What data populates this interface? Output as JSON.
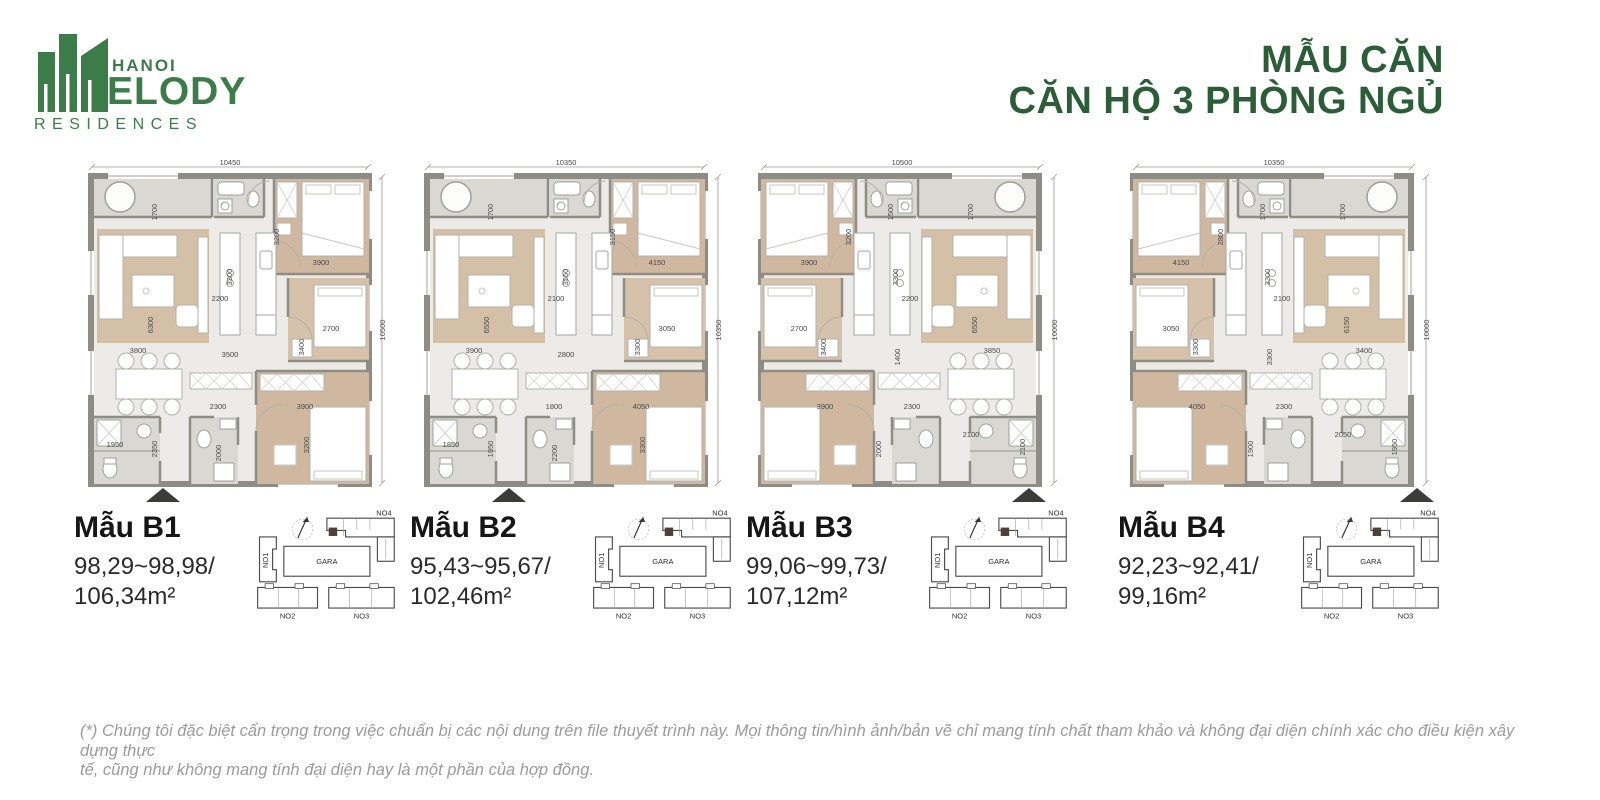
{
  "brand": {
    "hanoi": "HANOI",
    "melody": "ELODY",
    "residences": "RESIDENCES",
    "green": "#3c7c49"
  },
  "title": {
    "line1": "MẪU CĂN",
    "line2": "CĂN HỘ 3 PHÒNG NGỦ",
    "color": "#2b5d36"
  },
  "sitemap": {
    "no1": "NO1",
    "no2": "NO2",
    "no3": "NO3",
    "no4": "NO4",
    "gara": "GARA"
  },
  "plans": [
    {
      "name": "Mẫu B1",
      "area_line1": "98,29~98,98/",
      "area_line2": "106,34m²",
      "dims": {
        "top": "10450",
        "right": "10500",
        "a": "1700",
        "b": "3200",
        "c": "3900",
        "d": "2200",
        "e": "3300",
        "f": "6300",
        "g": "3800",
        "h": "3500",
        "i": "3400",
        "j": "2700",
        "k": "2300",
        "l": "3900",
        "m": "3200",
        "n": "1950",
        "o": "2350",
        "p": "2000"
      }
    },
    {
      "name": "Mẫu B2",
      "area_line1": "95,43~95,67/",
      "area_line2": "102,46m²",
      "dims": {
        "top": "10350",
        "right": "10350",
        "a": "1700",
        "b": "3150",
        "c": "4150",
        "d": "2100",
        "e": "3550",
        "f": "6550",
        "g": "3900",
        "h": "2800",
        "i": "3300",
        "j": "3050",
        "k": "1800",
        "l": "4050",
        "m": "3300",
        "n": "1850",
        "o": "1950",
        "p": "2200"
      }
    },
    {
      "name": "Mẫu B3",
      "area_line1": "99,06~99,73/",
      "area_line2": "107,12m²",
      "dims": {
        "top": "10500",
        "right": "10000",
        "a": "1700",
        "b": "3200",
        "c": "3900",
        "d": "2200",
        "e": "3300",
        "f": "6550",
        "g": "3850",
        "h": "1400",
        "i": "3400",
        "j": "2700",
        "k": "2300",
        "l": "3900",
        "m": "2000",
        "n": "2100",
        "o": "2100",
        "p": "1500"
      }
    },
    {
      "name": "Mẫu B4",
      "area_line1": "92,23~92,41/",
      "area_line2": "99,16m²",
      "dims": {
        "top": "10350",
        "right": "10000",
        "a": "1700",
        "b": "2800",
        "c": "4150",
        "d": "2100",
        "e": "3300",
        "f": "6150",
        "g": "3400",
        "h": "3300",
        "i": "3300",
        "j": "3050",
        "k": "2300",
        "l": "4050",
        "m": "1900",
        "n": "2050",
        "o": "1950",
        "p": "1700"
      }
    }
  ],
  "footer": {
    "line1": "(*) Chúng tôi đặc biệt cẩn trọng trong việc chuẩn bị các nội dung trên file thuyết trình này. Mọi thông tin/hình ảnh/bản vẽ chỉ mang tính chất tham khảo và không đại diện chính xác cho điều kiện xây dựng thực",
    "line2": "tế, cũng như không mang tính đại diện hay là một phần của hợp đồng."
  }
}
